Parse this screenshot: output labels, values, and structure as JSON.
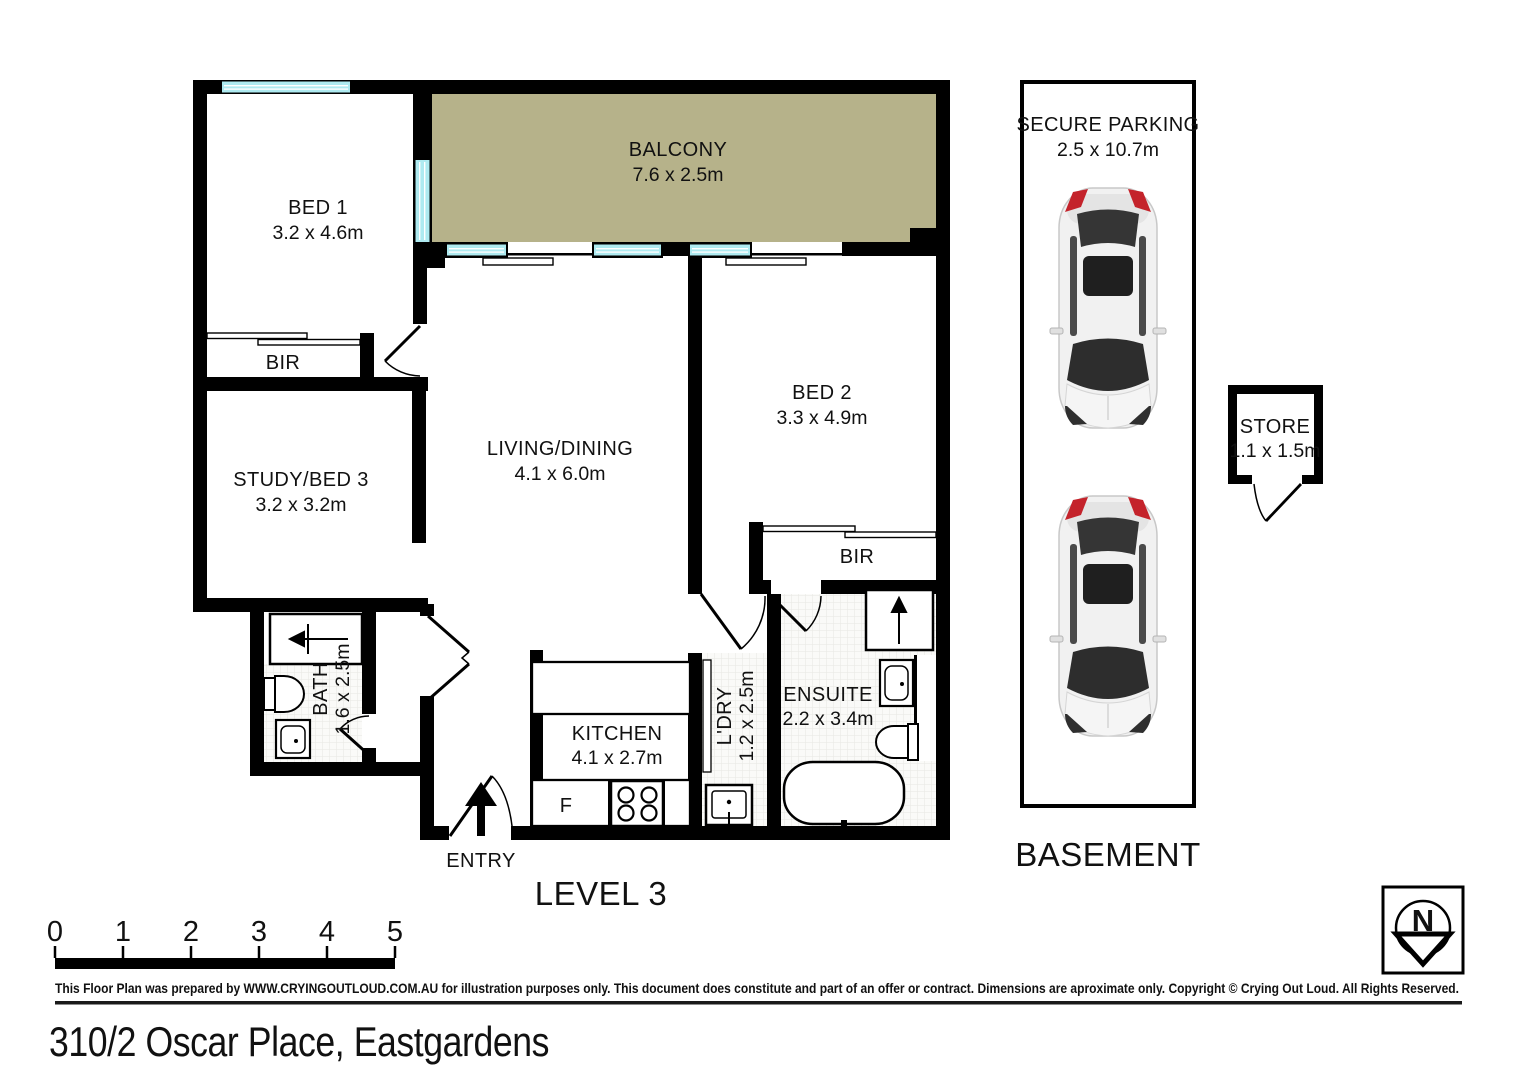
{
  "page": {
    "address": "310/2 Oscar Place, Eastgardens",
    "disclaimer": "This Floor Plan was prepared by WWW.CRYINGOUTLOUD.COM.AU for illustration purposes only. This document does constitute and part of an offer or contract. Dimensions are aproximate only. Copyright © Crying Out Loud. All Rights Reserved."
  },
  "level3": {
    "label": "LEVEL 3",
    "entry_label": "ENTRY",
    "fridge_label": "F",
    "rooms": {
      "bed1": {
        "name": "BED 1",
        "dims": "3.2 x 4.6m"
      },
      "balcony": {
        "name": "BALCONY",
        "dims": "7.6 x 2.5m"
      },
      "bed2": {
        "name": "BED 2",
        "dims": "3.3 x 4.9m"
      },
      "study": {
        "name": "STUDY/BED 3",
        "dims": "3.2 x 3.2m"
      },
      "living": {
        "name": "LIVING/DINING",
        "dims": "4.1 x 6.0m"
      },
      "kitchen": {
        "name": "KITCHEN",
        "dims": "4.1 x 2.7m"
      },
      "bath": {
        "name": "BATH",
        "dims": "1.6 x 2.5m"
      },
      "laundry": {
        "name": "L'DRY",
        "dims": "1.2 x 2.5m"
      },
      "ensuite": {
        "name": "ENSUITE",
        "dims": "2.2 x 3.4m"
      },
      "bir_bed1": {
        "name": "BIR"
      },
      "bir_bed2": {
        "name": "BIR"
      }
    }
  },
  "basement": {
    "label": "BASEMENT",
    "parking": {
      "name": "SECURE PARKING",
      "dims": "2.5 x 10.7m"
    },
    "store": {
      "name": "STORE",
      "dims": "1.1 x 1.5m"
    }
  },
  "scale_bar": {
    "ticks": [
      "0",
      "1",
      "2",
      "3",
      "4",
      "5"
    ]
  },
  "compass": {
    "letter": "N"
  },
  "colors": {
    "wall": "#000000",
    "balcony_fill": "#b6b28a",
    "window": "#aeeaf0",
    "car_red": "#c4232b",
    "tile_bg": "#fafaf8",
    "tile_line": "#e7e7e2"
  }
}
